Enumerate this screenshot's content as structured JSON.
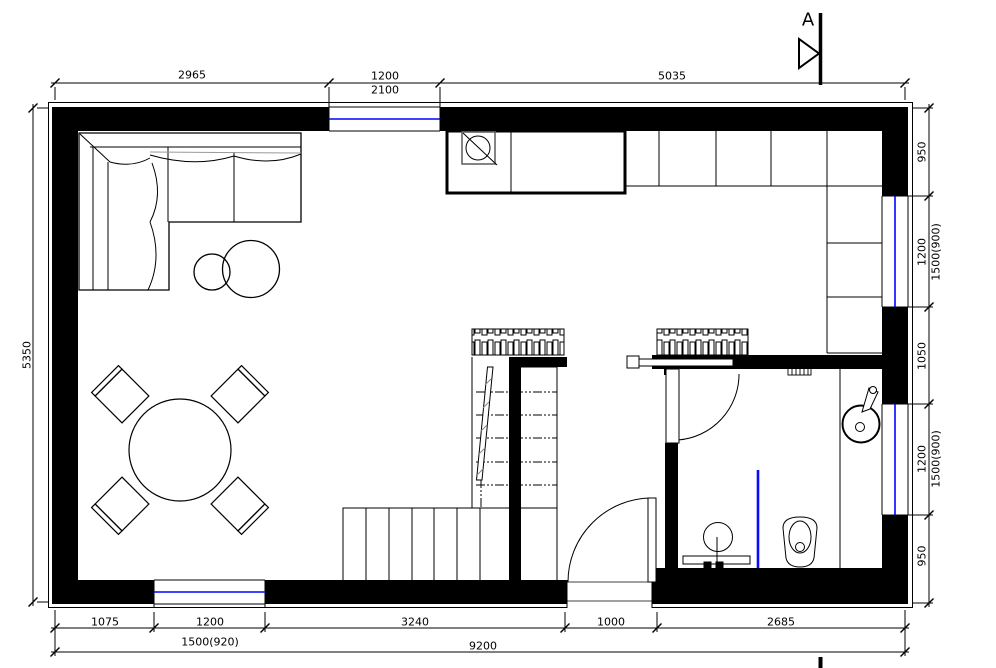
{
  "colors": {
    "wall_fill": "#000000",
    "window_glass_blue": "#0000ff",
    "shower_screen_blue": "#0a0aff",
    "hatch_grey": "#888888",
    "sink_box_grey": "#666666"
  },
  "section_marker": {
    "label": "A"
  },
  "dimensions": {
    "top": {
      "seg1": "2965",
      "seg2_width": "1200",
      "seg2_height": "2100",
      "seg3": "5035"
    },
    "left": {
      "height": "5350"
    },
    "right": {
      "seg1": "950",
      "seg2_width": "1200",
      "seg2_alt": "1500(900)",
      "seg3": "1050",
      "seg4_width": "1200",
      "seg4_alt": "1500(900)",
      "seg5": "950"
    },
    "bottom": {
      "seg1": "1075",
      "seg2_width": "1200",
      "seg2_alt": "1500(920)",
      "seg3": "3240",
      "seg4": "1000",
      "seg5": "2685",
      "total": "9200"
    }
  }
}
